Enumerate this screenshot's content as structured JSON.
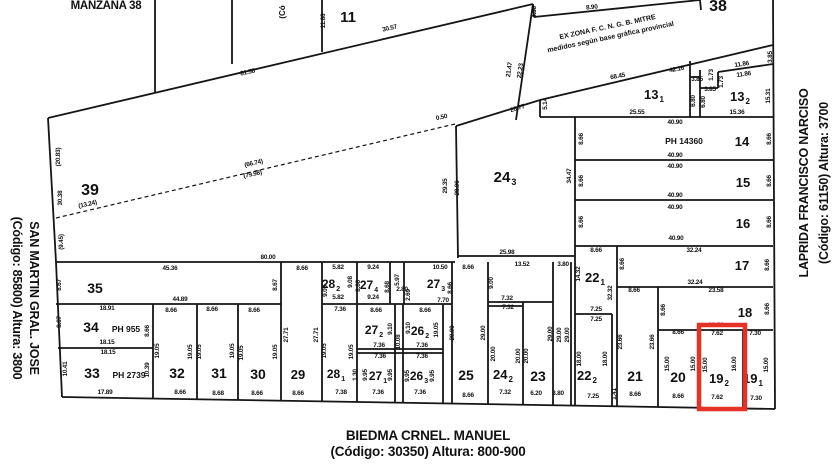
{
  "map_title": "MANZANA 38",
  "streets": {
    "left_line1": "SAN MARTIN GRAL. JOSE",
    "left_line2": "(Código: 85800) Altura: 3800",
    "right_line1": "LAPRIDA FRANCISCO NARCISO",
    "right_line2": "(Código: 61150) Altura: 3700",
    "bottom_line1": "BIEDMA CRNEL. MANUEL",
    "bottom_line2": "(Código: 30350) Altura: 800-900",
    "top_fragment": "(Có"
  },
  "zone_note_line1": "EX ZONA F. C. N. G. B. MITRE",
  "zone_note_line2": "medidos según base gráfica provincial",
  "highlight": {
    "parcel": "19 2",
    "x": 699,
    "y": 325,
    "w": 46,
    "h": 84,
    "color": "#e63127",
    "stroke_width": 4.5
  },
  "colors": {
    "line": "#151515",
    "background": "#ffffff"
  },
  "parcels": [
    {
      "n": "11",
      "s": "",
      "x": 348,
      "y": 22,
      "fs": 15
    },
    {
      "n": "38",
      "s": "",
      "x": 718,
      "y": 11,
      "fs": 16
    },
    {
      "n": "39",
      "s": "",
      "x": 90,
      "y": 195,
      "fs": 16
    },
    {
      "n": "13",
      "s": "1",
      "x": 654,
      "y": 99,
      "fs": 13
    },
    {
      "n": "13",
      "s": "2",
      "x": 740,
      "y": 101,
      "fs": 13
    },
    {
      "n": "14",
      "s": "",
      "x": 742,
      "y": 146,
      "fs": 13
    },
    {
      "n": "15",
      "s": "",
      "x": 743,
      "y": 187,
      "fs": 13
    },
    {
      "n": "16",
      "s": "",
      "x": 743,
      "y": 228,
      "fs": 13
    },
    {
      "n": "17",
      "s": "",
      "x": 742,
      "y": 270,
      "fs": 13
    },
    {
      "n": "18",
      "s": "",
      "x": 745,
      "y": 317,
      "fs": 13
    },
    {
      "n": "24",
      "s": "3",
      "x": 505,
      "y": 182,
      "fs": 15
    },
    {
      "n": "22",
      "s": "1",
      "x": 595,
      "y": 282,
      "fs": 13
    },
    {
      "n": "35",
      "s": "",
      "x": 95,
      "y": 293,
      "fs": 14
    },
    {
      "n": "34",
      "s": "",
      "x": 91,
      "y": 332,
      "fs": 14
    },
    {
      "n": "33",
      "s": "",
      "x": 92,
      "y": 378,
      "fs": 14
    },
    {
      "n": "32",
      "s": "",
      "x": 177,
      "y": 378,
      "fs": 14
    },
    {
      "n": "31",
      "s": "",
      "x": 219,
      "y": 378,
      "fs": 14
    },
    {
      "n": "30",
      "s": "",
      "x": 258,
      "y": 379,
      "fs": 14
    },
    {
      "n": "29",
      "s": "",
      "x": 298,
      "y": 379,
      "fs": 13
    },
    {
      "n": "28",
      "s": "1",
      "x": 336,
      "y": 378,
      "fs": 12
    },
    {
      "n": "27",
      "s": "1",
      "x": 378,
      "y": 380,
      "fs": 12
    },
    {
      "n": "26",
      "s": "3",
      "x": 419,
      "y": 380,
      "fs": 12
    },
    {
      "n": "25",
      "s": "",
      "x": 466,
      "y": 380,
      "fs": 14
    },
    {
      "n": "24",
      "s": "2",
      "x": 503,
      "y": 379,
      "fs": 13
    },
    {
      "n": "23",
      "s": "",
      "x": 538,
      "y": 381,
      "fs": 14
    },
    {
      "n": "22",
      "s": "2",
      "x": 587,
      "y": 380,
      "fs": 13
    },
    {
      "n": "21",
      "s": "",
      "x": 635,
      "y": 381,
      "fs": 14
    },
    {
      "n": "20",
      "s": "",
      "x": 678,
      "y": 382,
      "fs": 14
    },
    {
      "n": "19",
      "s": "2",
      "x": 719,
      "y": 383,
      "fs": 13
    },
    {
      "n": "19",
      "s": "1",
      "x": 753,
      "y": 383,
      "fs": 13
    },
    {
      "n": "28",
      "s": "2",
      "x": 331,
      "y": 288,
      "fs": 12
    },
    {
      "n": "27",
      "s": "4",
      "x": 369,
      "y": 289,
      "fs": 12
    },
    {
      "n": "27",
      "s": "3",
      "x": 436,
      "y": 288,
      "fs": 12
    },
    {
      "n": "27",
      "s": "2",
      "x": 374,
      "y": 334,
      "fs": 12
    },
    {
      "n": "26",
      "s": "2",
      "x": 420,
      "y": 335,
      "fs": 12
    }
  ],
  "ph_labels": [
    {
      "t": "PH 14360",
      "x": 684,
      "y": 144
    },
    {
      "t": "PH 955",
      "x": 126,
      "y": 332
    },
    {
      "t": "PH 2739",
      "x": 129,
      "y": 378
    }
  ],
  "measurements": [
    [
      "11.88",
      325,
      21,
      -90
    ],
    [
      "30.57",
      390,
      30,
      -13
    ],
    [
      "81.58",
      248,
      74,
      -13
    ],
    [
      "4.38",
      536,
      12,
      -90
    ],
    [
      "8.90",
      592,
      9,
      -6
    ],
    [
      "21.47",
      511,
      70,
      -82
    ],
    [
      "22.23",
      522,
      71,
      -82
    ],
    [
      "26.77",
      518,
      110,
      -17
    ],
    [
      "0.50",
      442,
      119,
      -13
    ],
    [
      "5.14",
      547,
      104,
      -90
    ],
    [
      "68.45",
      618,
      78,
      -11
    ],
    [
      "42.16",
      677,
      71,
      -11
    ],
    [
      "3.85",
      697,
      81,
      0
    ],
    [
      "3.85",
      710,
      91,
      0
    ],
    [
      "1.73",
      713,
      75,
      -90
    ],
    [
      "1.73",
      723,
      82,
      -90
    ],
    [
      "11.86",
      742,
      66,
      -8
    ],
    [
      "11.86",
      744,
      76,
      -8
    ],
    [
      "6.80",
      695,
      101,
      -90
    ],
    [
      "6.80",
      705,
      102,
      -90
    ],
    [
      "3.85",
      772,
      57,
      -90
    ],
    [
      "15.31",
      770,
      96,
      -90
    ],
    [
      "25.55",
      637,
      114,
      0
    ],
    [
      "15.36",
      737,
      114,
      0
    ],
    [
      "(20.83)",
      60,
      157,
      -90
    ],
    [
      "30.38",
      62,
      198,
      -90
    ],
    [
      "(9.45)",
      63,
      242,
      -90
    ],
    [
      "(13.24)",
      88,
      206,
      -13
    ],
    [
      "(66.74)",
      254,
      165,
      -13
    ],
    [
      "(79.98)",
      253,
      176,
      -13
    ],
    [
      "80.00",
      268,
      259,
      0
    ],
    [
      "45.36",
      170,
      270,
      0
    ],
    [
      "29.35",
      447,
      186,
      -90
    ],
    [
      "28.06",
      459,
      188,
      -90
    ],
    [
      "34.47",
      571,
      176,
      -90
    ],
    [
      "25.98",
      507,
      254,
      0
    ],
    [
      "40.90",
      675,
      124,
      0
    ],
    [
      "40.90",
      675,
      157,
      0
    ],
    [
      "40.90",
      675,
      168,
      0
    ],
    [
      "40.90",
      675,
      197,
      0
    ],
    [
      "40.90",
      675,
      209,
      0
    ],
    [
      "40.90",
      676,
      240,
      0
    ],
    [
      "8.66",
      583,
      139,
      -90
    ],
    [
      "8.66",
      583,
      181,
      -90
    ],
    [
      "8.66",
      583,
      222,
      -90
    ],
    [
      "8.66",
      771,
      139,
      -90
    ],
    [
      "8.66",
      771,
      181,
      -90
    ],
    [
      "8.66",
      771,
      222,
      -90
    ],
    [
      "32.24",
      694,
      252,
      0
    ],
    [
      "32.24",
      695,
      284,
      0
    ],
    [
      "8.66",
      769,
      265,
      -90
    ],
    [
      "8.66",
      624,
      264,
      -90
    ],
    [
      "14.32",
      580,
      274,
      -90
    ],
    [
      "8.66",
      596,
      252,
      0
    ],
    [
      "32.32",
      612,
      293,
      -90
    ],
    [
      "23.58",
      716,
      292,
      0
    ],
    [
      "23.58",
      716,
      327,
      0
    ],
    [
      "8.66",
      665,
      310,
      -90
    ],
    [
      "8.66",
      769,
      309,
      -90
    ],
    [
      "7.25",
      596,
      311,
      0
    ],
    [
      "7.25",
      596,
      321,
      0
    ],
    [
      "8.66",
      634,
      292,
      0
    ],
    [
      "23.66",
      622,
      342,
      -90
    ],
    [
      "23.66",
      654,
      342,
      -90
    ],
    [
      "18.00",
      581,
      359,
      -90
    ],
    [
      "18.00",
      607,
      359,
      -90
    ],
    [
      "8.66",
      678,
      334,
      0
    ],
    [
      "15.00",
      669,
      364,
      -90
    ],
    [
      "15.00",
      695,
      364,
      -90
    ],
    [
      "7.62",
      717,
      335,
      0
    ],
    [
      "7.30",
      755,
      335,
      0
    ],
    [
      "15.00",
      707,
      365,
      -90
    ],
    [
      "16.00",
      736,
      364,
      -90
    ],
    [
      "16.00",
      747,
      365,
      -90
    ],
    [
      "15.00",
      768,
      365,
      -90
    ],
    [
      "17.89",
      105,
      394,
      0
    ],
    [
      "8.66",
      180,
      394,
      0
    ],
    [
      "8.68",
      218,
      395,
      0
    ],
    [
      "8.66",
      257,
      395,
      0
    ],
    [
      "8.66",
      298,
      395,
      0
    ],
    [
      "7.38",
      341,
      394,
      0
    ],
    [
      "7.36",
      378,
      394,
      0
    ],
    [
      "7.36",
      420,
      394,
      0
    ],
    [
      "8.66",
      468,
      397,
      0
    ],
    [
      "7.32",
      505,
      394,
      0
    ],
    [
      "6.20",
      536,
      395,
      0
    ],
    [
      "3.80",
      558,
      395,
      0
    ],
    [
      "7.25",
      593,
      398,
      0
    ],
    [
      "1.41",
      616,
      394,
      -90
    ],
    [
      "8.66",
      635,
      396,
      0
    ],
    [
      "8.66",
      678,
      398,
      0
    ],
    [
      "7.62",
      717,
      399,
      0
    ],
    [
      "7.30",
      756,
      400,
      0
    ],
    [
      "8.66",
      302,
      270,
      0
    ],
    [
      "27.71",
      288,
      335,
      -90
    ],
    [
      "27.71",
      318,
      335,
      -90
    ],
    [
      "5.82",
      338,
      269,
      0
    ],
    [
      "5.82",
      338,
      299,
      0
    ],
    [
      "9.06",
      327,
      291,
      -90
    ],
    [
      "9.08",
      352,
      282,
      -90
    ],
    [
      "9.24",
      373,
      269,
      0
    ],
    [
      "9.24",
      373,
      299,
      0
    ],
    [
      "8.66",
      360,
      286,
      -90
    ],
    [
      "8.68",
      389,
      287,
      -90
    ],
    [
      "5.97",
      399,
      280,
      -90
    ],
    [
      "2.80",
      402,
      291,
      0
    ],
    [
      "2.69",
      410,
      295,
      -90
    ],
    [
      "10.50",
      440,
      269,
      0
    ],
    [
      "7.70",
      443,
      302,
      0
    ],
    [
      "8.66",
      452,
      288,
      -90
    ],
    [
      "7.36",
      340,
      311,
      0
    ],
    [
      "8.66",
      376,
      312,
      0
    ],
    [
      "8.66",
      425,
      312,
      0
    ],
    [
      "19.05",
      326,
      351,
      -90
    ],
    [
      "19.05",
      353,
      352,
      -90
    ],
    [
      "9.10",
      392,
      329,
      -90
    ],
    [
      "9.10",
      410,
      328,
      -90
    ],
    [
      "19.05",
      438,
      330,
      -90
    ],
    [
      "10.08",
      400,
      342,
      -90
    ],
    [
      "7.36",
      379,
      347,
      0
    ],
    [
      "7.36",
      422,
      347,
      0
    ],
    [
      "7.36",
      380,
      358,
      0
    ],
    [
      "7.36",
      422,
      358,
      0
    ],
    [
      "9.95",
      367,
      375,
      -90
    ],
    [
      "9.95",
      392,
      375,
      -90
    ],
    [
      "9.95",
      409,
      376,
      -90
    ],
    [
      "9.95",
      434,
      376,
      -90
    ],
    [
      "1.30",
      357,
      375,
      -90
    ],
    [
      "19.05",
      159,
      351,
      -90
    ],
    [
      "19.05",
      192,
      352,
      -90
    ],
    [
      "19.05",
      201,
      352,
      -90
    ],
    [
      "19.05",
      234,
      351,
      -90
    ],
    [
      "19.05",
      243,
      353,
      -90
    ],
    [
      "19.05",
      277,
      352,
      -90
    ],
    [
      "8.66",
      171,
      312,
      0
    ],
    [
      "8.66",
      212,
      311,
      0
    ],
    [
      "8.66",
      254,
      312,
      0
    ],
    [
      "18.91",
      107,
      310,
      0
    ],
    [
      "18.15",
      107,
      344,
      0
    ],
    [
      "18.15",
      108,
      354,
      0
    ],
    [
      "8.67",
      61,
      322,
      -90
    ],
    [
      "8.66",
      149,
      331,
      -90
    ],
    [
      "10.41",
      67,
      369,
      -90
    ],
    [
      "10.39",
      149,
      370,
      -90
    ],
    [
      "8.67",
      61,
      285,
      -90
    ],
    [
      "8.67",
      277,
      285,
      -90
    ],
    [
      "44.89",
      180,
      301,
      0
    ],
    [
      "8.66",
      468,
      269,
      0
    ],
    [
      "29.00",
      454,
      333,
      -90
    ],
    [
      "29.00",
      485,
      333,
      -90
    ],
    [
      "13.52",
      522,
      266,
      0
    ],
    [
      "3.80",
      563,
      266,
      0
    ],
    [
      "9.00",
      493,
      283,
      -90
    ],
    [
      "7.32",
      507,
      300,
      0
    ],
    [
      "7.32",
      508,
      309,
      0
    ],
    [
      "20.00",
      495,
      354,
      -90
    ],
    [
      "20.00",
      520,
      356,
      -90
    ],
    [
      "20.00",
      528,
      356,
      -90
    ],
    [
      "29.00",
      552,
      334,
      -90
    ],
    [
      "29.00",
      561,
      335,
      -90
    ],
    [
      "29.00",
      569,
      335,
      -90
    ]
  ],
  "lines": [
    [
      155,
      0,
      155,
      92
    ],
    [
      322,
      0,
      322,
      52
    ],
    [
      232,
      0,
      232,
      64
    ],
    [
      48,
      118,
      533,
      4
    ],
    [
      533,
      4,
      534,
      17
    ],
    [
      534,
      17,
      700,
      0
    ],
    [
      700,
      0,
      701,
      10
    ],
    [
      516,
      120,
      533,
      4
    ],
    [
      48,
      118,
      56,
      262
    ],
    [
      56,
      262,
      62,
      397
    ],
    [
      62,
      397,
      775,
      409
    ],
    [
      773,
      0,
      775,
      409
    ],
    [
      456,
      126,
      540,
      100
    ],
    [
      540,
      100,
      773,
      45
    ],
    [
      456,
      126,
      458,
      258
    ],
    [
      458,
      256,
      575,
      256
    ],
    [
      56,
      262,
      455,
      262
    ],
    [
      540,
      100,
      540,
      117
    ],
    [
      540,
      117,
      773,
      117
    ],
    [
      575,
      117,
      575,
      406
    ],
    [
      575,
      160,
      773,
      160
    ],
    [
      575,
      200,
      773,
      200
    ],
    [
      575,
      246,
      773,
      246
    ],
    [
      617,
      287,
      773,
      287
    ],
    [
      658,
      330,
      773,
      330
    ],
    [
      617,
      246,
      617,
      406
    ],
    [
      658,
      287,
      658,
      407
    ],
    [
      700,
      330,
      700,
      408
    ],
    [
      743,
      330,
      743,
      408
    ],
    [
      690,
      61,
      690,
      117
    ],
    [
      700,
      70,
      700,
      117
    ],
    [
      690,
      77,
      700,
      77
    ],
    [
      700,
      88,
      718,
      88
    ],
    [
      718,
      72,
      718,
      88
    ],
    [
      718,
      72,
      773,
      64
    ],
    [
      575,
      314,
      612,
      314
    ],
    [
      612,
      314,
      612,
      406
    ],
    [
      281,
      262,
      281,
      401
    ],
    [
      322,
      262,
      322,
      401
    ],
    [
      153,
      304,
      153,
      399
    ],
    [
      197,
      304,
      197,
      399
    ],
    [
      238,
      304,
      238,
      400
    ],
    [
      56,
      304,
      281,
      304
    ],
    [
      58,
      348,
      153,
      348
    ],
    [
      357,
      262,
      357,
      402
    ],
    [
      390,
      262,
      390,
      304
    ],
    [
      404,
      262,
      404,
      304
    ],
    [
      322,
      304,
      452,
      304
    ],
    [
      395,
      304,
      395,
      403
    ],
    [
      403,
      304,
      403,
      403
    ],
    [
      357,
      349,
      443,
      349
    ],
    [
      357,
      353,
      443,
      353
    ],
    [
      443,
      304,
      443,
      403
    ],
    [
      452,
      262,
      452,
      404
    ],
    [
      488,
      262,
      488,
      404
    ],
    [
      488,
      302,
      553,
      302
    ],
    [
      488,
      306,
      523,
      306
    ],
    [
      523,
      302,
      523,
      405
    ],
    [
      553,
      262,
      553,
      405
    ],
    [
      571,
      262,
      571,
      406
    ]
  ],
  "dotted_lines": [
    [
      56,
      218,
      455,
      124
    ]
  ]
}
